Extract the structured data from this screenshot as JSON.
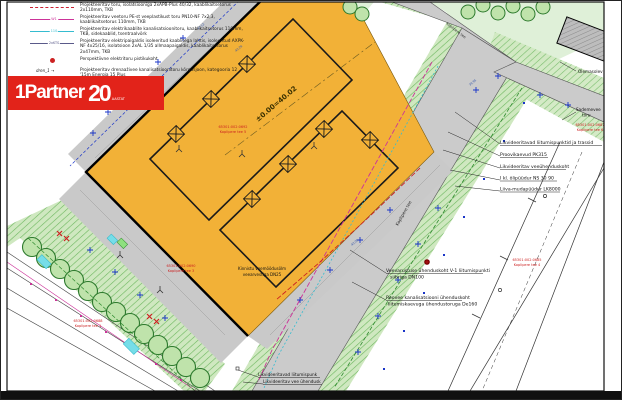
{
  "logo": {
    "brand": "1Partner",
    "years": "20",
    "years_label": "AASTAT",
    "banner_color": "#e2231a"
  },
  "legend": {
    "rows": [
      {
        "code": "",
        "label": "Projekteeritav toru, isolatsiooniga 2xAPB-Plus 40/32, kaablikaitsetorus 2x110mm, TKB"
      },
      {
        "code": "W1",
        "label": "Projekteeritav veetoru PE-st veeplastikust toru PN10-NF 7x2,3, kaablikaitsetorus 110mm, TKB"
      },
      {
        "code": "110",
        "label": "Projekteeritav elektrikaablite kanalisatsioonitoru, kaablikaitsetorus 110mm, TKB, sidekaablid, tsentraalvõrk"
      },
      {
        "code": "2xKTS",
        "label": "Projekteeritav elektripaigaldis isoleeritud kaablitega lahtis, isoleeritud AXPK-NF 4x25/16, isolatsioon 2xAL 1/35 allmaapaigaldis, kaablikaitsetorus 2x47mm, TKB"
      },
      {
        "code": "",
        "label": "Perspektiivne elektritoru pistikukoht"
      },
      {
        "code": "dren_1 →",
        "label": "Projekteeritav drenaaživee kanalisatsioonitoru kõrgusjoon, kategooria 12 '15m Energia 15 Plus"
      },
      {
        "code": "",
        "label": "Projekteeritav plaatala, 400-2"
      }
    ]
  },
  "annotations": {
    "right": [
      "Likvideeritavad liitumispunktid ja trassid",
      "Proovikaevud PK315",
      "Likvideeritav veeühenduskoht",
      "I kl. õlipüüdur NS 30 90",
      "Liiva-mudapüüdur LK8000"
    ],
    "veevarustus": {
      "line1": "Veevarustuse ühenduskoht V-1 liitumispunkti",
      "line2": "siibriga DN100"
    },
    "reovesi": {
      "line1": "Reovee kanalisatsiooni ühenduskoht",
      "line2": "liitumiskaevuga ühendustoruga De160"
    },
    "bottom": [
      "Likvideeritavad liitumispunk",
      "Likvideeritav vee ühendusk"
    ],
    "olemasolev": "Olemasolev",
    "sademevee": {
      "line1": "Sademevee",
      "line2": "toru"
    },
    "veemoodusolm": {
      "line1": "Kinnistu veemõõdusõlm",
      "line2": "veearvestiga DN25"
    },
    "level_mark": "±0.00=40.02"
  },
  "parcels": [
    {
      "code": "65301:002:0692",
      "name": "Koplipere tee 5"
    },
    {
      "code": "65301:002:0690",
      "name": "Koplipere tee 3"
    },
    {
      "code": "65301:002:0688",
      "name": "Koplipere tee 1"
    },
    {
      "code": "65301:002:0685",
      "name": "Koplipere tee 4"
    },
    {
      "code": "65301:002:0687",
      "name": "Koplipere tee 6"
    }
  ],
  "streets": {
    "main": "Koplipere tee",
    "top": "Koplipere tee"
  },
  "elevations": [
    "40.12",
    "40.28",
    "39.95",
    "40.05"
  ],
  "colors": {
    "parcel_orange": "#f2b137",
    "road_gray": "#cbcbcb",
    "green_light": "#dff0d8",
    "verge_green": "#bfe0a8",
    "tree_green": "#3d8b37",
    "logo_red": "#e2231a",
    "label_red": "#cc2222",
    "magenta": "#cc3399",
    "cyan": "#35bcd0",
    "blue": "#1a35c8"
  }
}
